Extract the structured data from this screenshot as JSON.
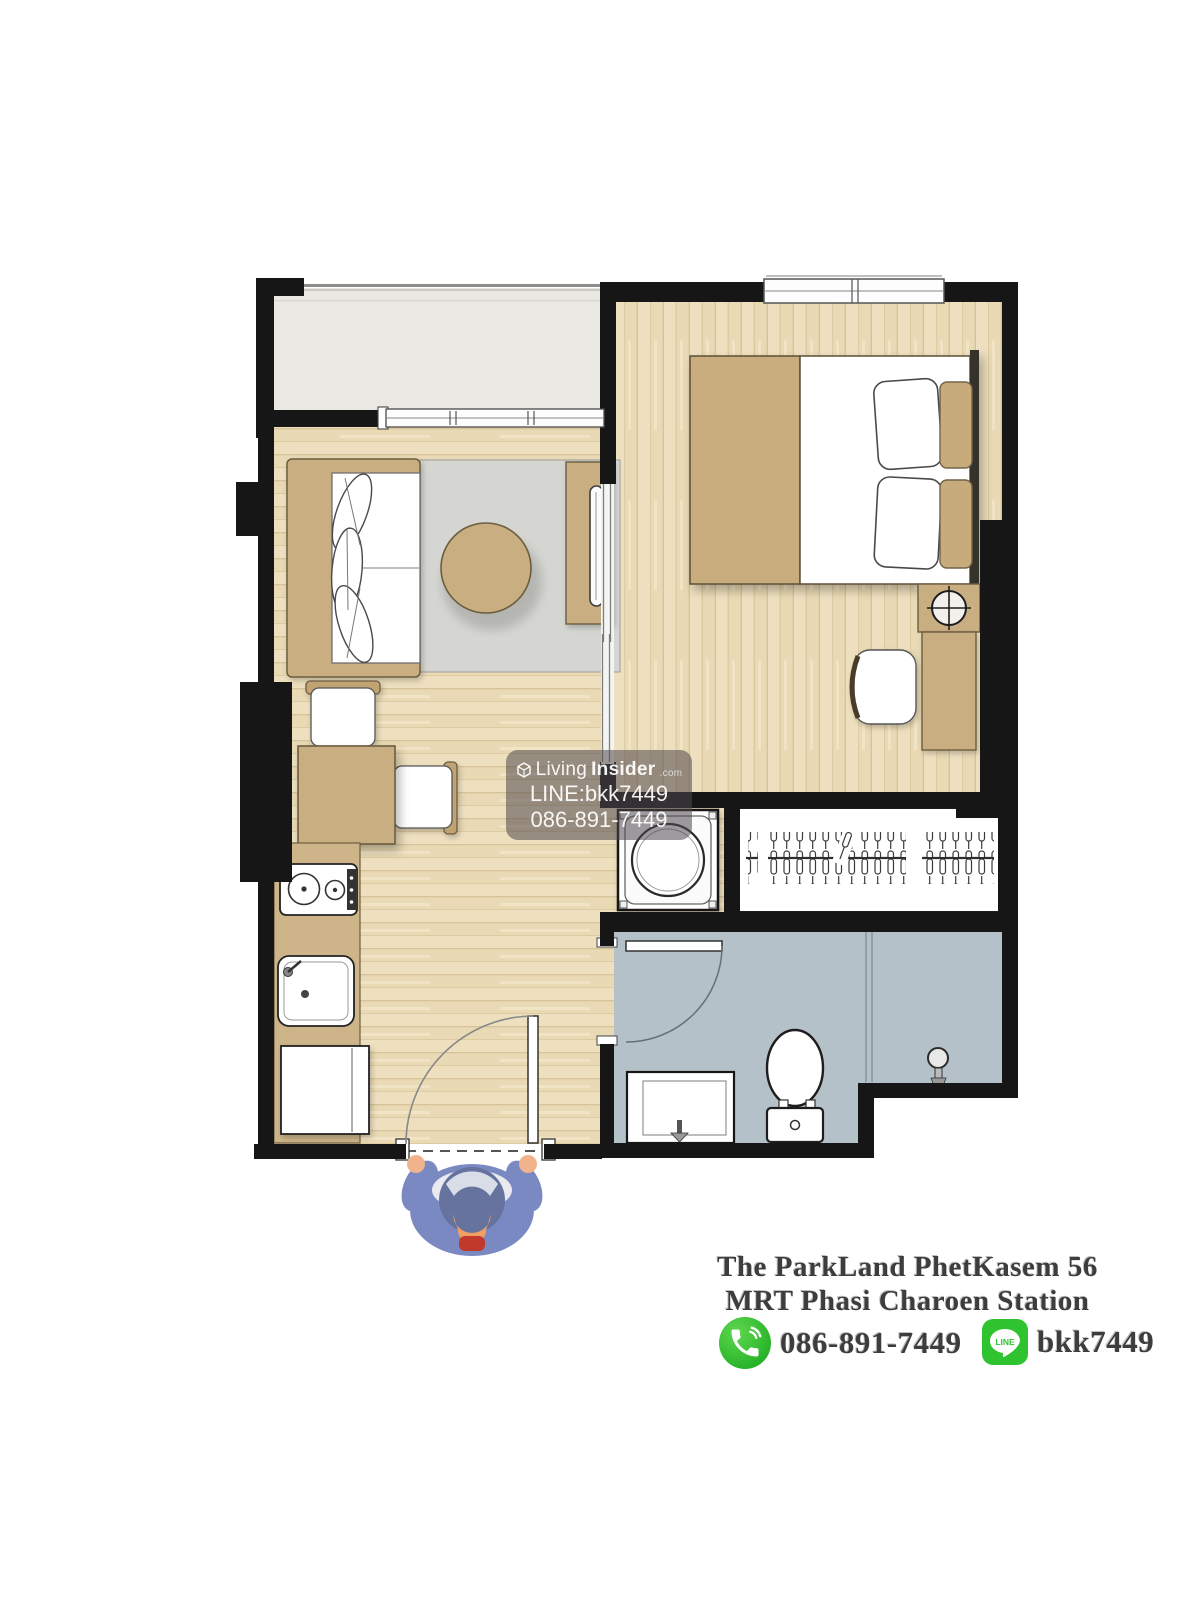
{
  "watermark": {
    "brand_light": "Living",
    "brand_bold": "Insider",
    "brand_suffix": ".com",
    "line_id": "LINE:bkk7449",
    "phone": "086-891-7449"
  },
  "footer": {
    "title_line1": "The ParkLand PhetKasem 56",
    "title_line2": "MRT Phasi Charoen Station",
    "phone": "086-891-7449",
    "line_id": "bkk7449",
    "line_icon_label": "LINE"
  },
  "icons": {
    "livinginsider_logo": "cube-box-logo",
    "phone_contact": "phone-handset-in-green-circle",
    "line_contact": "line-speech-bubble-in-green-square",
    "bedroom_lamp": "crosshair-circle-lamp",
    "shower": "shower-head",
    "entrance_person": "top-down-person-figure"
  },
  "colors": {
    "wall": "#161616",
    "wood_floor": "#e9d9b4",
    "balcony_floor": "#eae8e2",
    "bathroom_floor": "#b5c1c8",
    "furniture_tan": "#c9ae82",
    "rug_gray": "#d5d6d1",
    "watermark_bg": "rgba(78,71,77,0.55)",
    "phone_icon_green": "#34c334",
    "line_icon_green": "#2fc42f",
    "footer_text": "#3d3d3d"
  }
}
